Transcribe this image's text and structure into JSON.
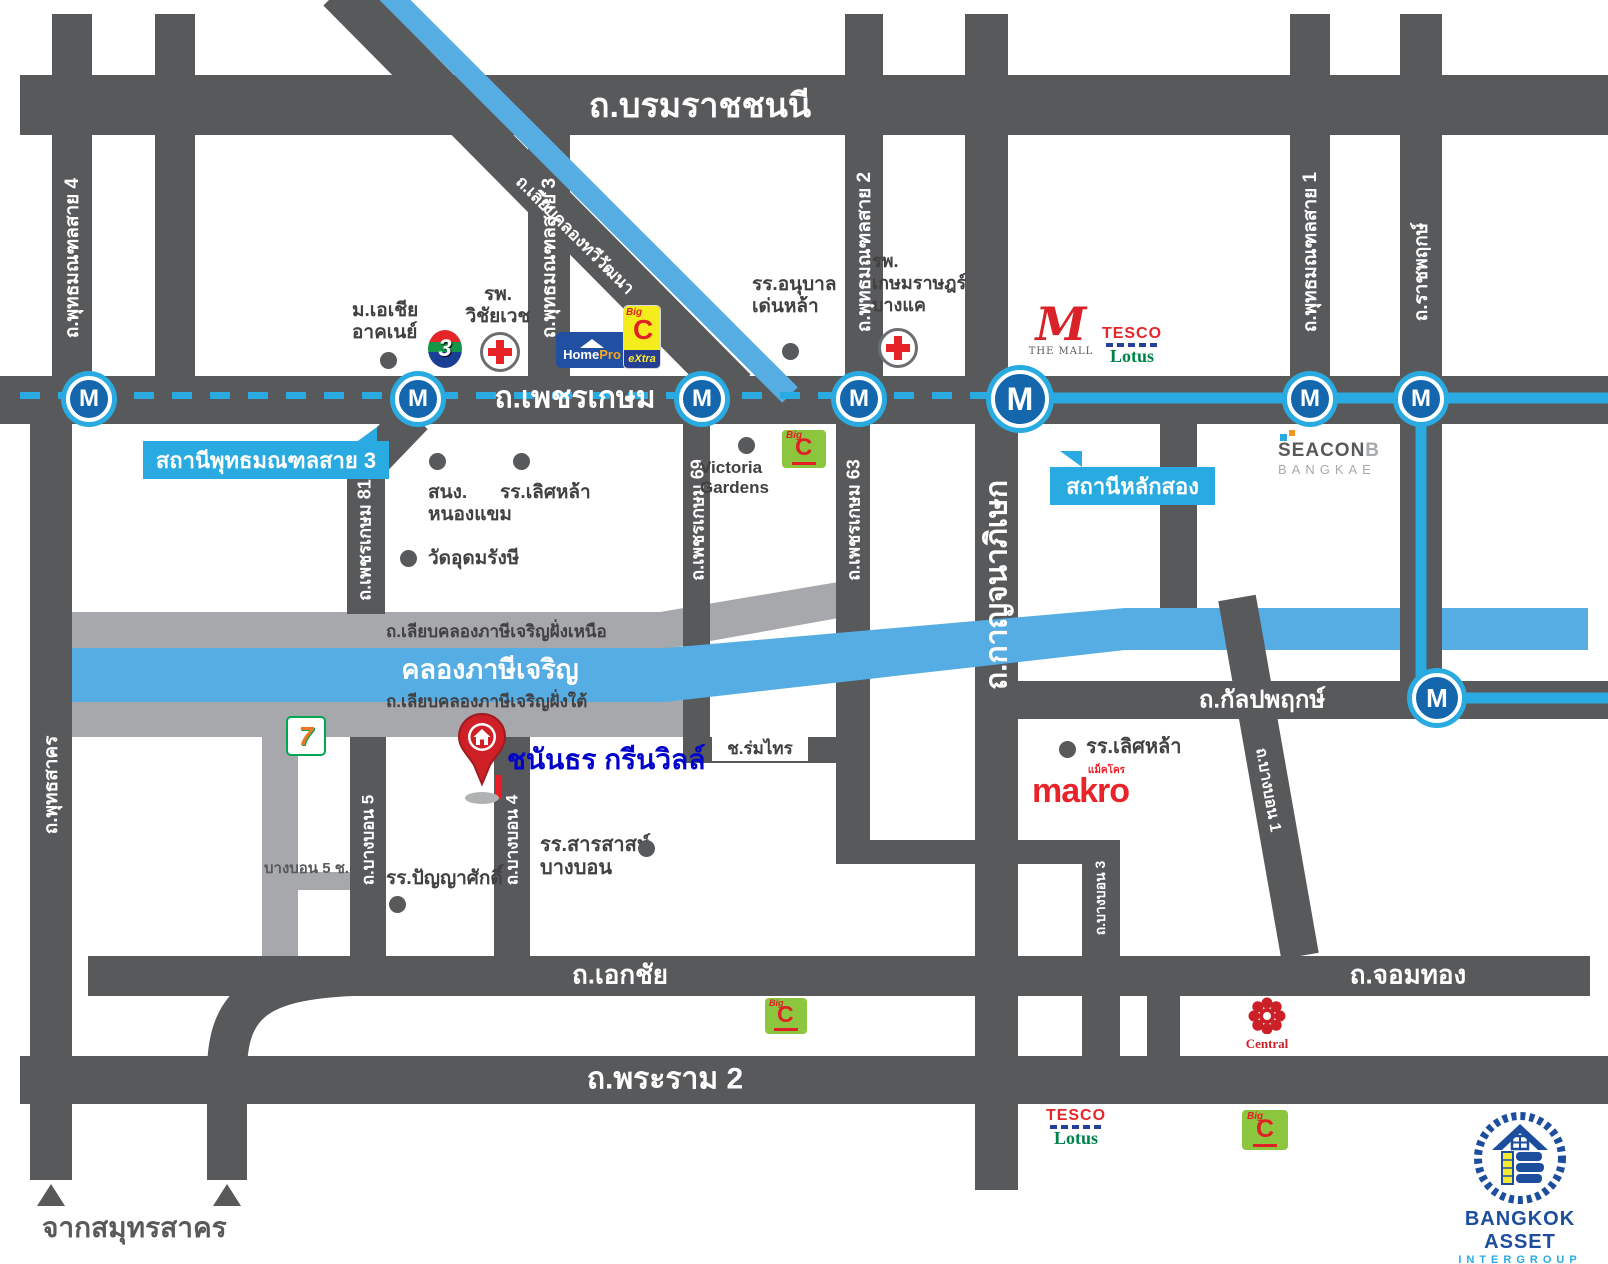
{
  "property": {
    "name": "ชนันธร กรีนวิลล์"
  },
  "roads": {
    "borommaratchachonnani": "ถ.บรมราชชนนี",
    "phetkasem": "ถ.เพชรเกษม",
    "ekachai": "ถ.เอกชัย",
    "chomthong": "ถ.จอมทอง",
    "rama2": "ถ.พระราม 2",
    "kanlapaphruek": "ถ.กัลปพฤกษ์",
    "sai4": "ถ.พุทธมณฑลสาย 4",
    "sai3": "ถ.พุทธมณฑลสาย 3",
    "sai2": "ถ.พุทธมณฑลสาย 2",
    "sai1": "ถ.พุทธมณฑลสาย 1",
    "ratchaphruek": "ถ.ราชพฤกษ์",
    "phutthasakhon": "ถ.พุทธสาคร",
    "kanchanaphisek": "ถ.กาญจนาภิเษก",
    "phetkasem81": "ถ.เพชรเกษม 81",
    "phetkasem69": "ถ.เพชรเกษม 69",
    "phetkasem63": "ถ.เพชรเกษม 63",
    "liap_north": "ถ.เลียบคลองภาษีเจริญฝั่งเหนือ",
    "liap_south": "ถ.เลียบคลองภาษีเจริญฝั่งใต้",
    "liap_thawiwatthana": "ถ.เลียบคลองทวีวัฒนา",
    "bangbon5": "ถ.บางบอน 5",
    "bangbon4": "ถ.บางบอน 4",
    "bangbon3": "ถ.บางบอน 3",
    "bangbon1": "ถ.บางบอน 1",
    "bangbon5_soi5": "บางบอน 5 ช.5",
    "romsai": "ช.ร่มไทร",
    "from_samut_sakhon": "จากสมุทรสาคร"
  },
  "canal": {
    "name": "คลองภาษีเจริญ"
  },
  "stations": {
    "letter": "M",
    "callout_sai3": "สถานีพุทธมณฑลสาย 3",
    "callout_laksong": "สถานีหลักสอง"
  },
  "pois": {
    "asia_line1": "ม.เอเชีย",
    "asia_line2": "อาคเนย์",
    "wichaiyawet_line1": "รพ.",
    "wichaiyawet_line2": "วิชัยเวช",
    "anuban_line1": "รร.อนุบาล",
    "anuban_line2": "เด่นหล้า",
    "kasemrad_line1": "รพ.",
    "kasemrad_line2": "เกษมราษฎร์",
    "kasemrad_line3": "บางแค",
    "nongkhaem_line1": "สนง.",
    "nongkhaem_line2": "หนองแขม",
    "lertlah_phetkasem": "รร.เลิศหล้า",
    "wat_udomrangsi": "วัดอุดมรังษี",
    "victoria_line1": "Victoria",
    "victoria_line2": "Gardens",
    "lertlah_kanlapaphruek": "รร.เลิศหล้า",
    "sarasas_line1": "รร.สารสาสน์",
    "sarasas_line2": "บางบอน",
    "panyasak": "รร.ปัญญาศักดิ์"
  },
  "logos": {
    "homepro_home": "Home",
    "homepro_pro": "Pro",
    "bigc_big": "Big",
    "bigc_c": "C",
    "bigc_extra": "eXtra",
    "ch3": "3",
    "themall_m": "M",
    "themall_text": "THE MALL",
    "tesco": "TESCO",
    "lotus": "Lotus",
    "seacon": "SEACON",
    "seacon_b": "B",
    "seacon_bangkae": "BANGKAE",
    "seven": "7",
    "makro": "makro",
    "makro_thai": "แม็คโคร",
    "central": "Central",
    "brand_name": "BANGKOK ASSET",
    "brand_sub": "INTERGROUP"
  },
  "colors": {
    "road": "#58595b",
    "road_light": "#a6a8ab",
    "canal": "#55ade3",
    "mrt": "#29abe2",
    "station_fill": "#1467ad",
    "callout": "#29abe2",
    "pin": "#cf2027",
    "property_text": "#0101cc",
    "brand_blue": "#1d4e9e"
  }
}
